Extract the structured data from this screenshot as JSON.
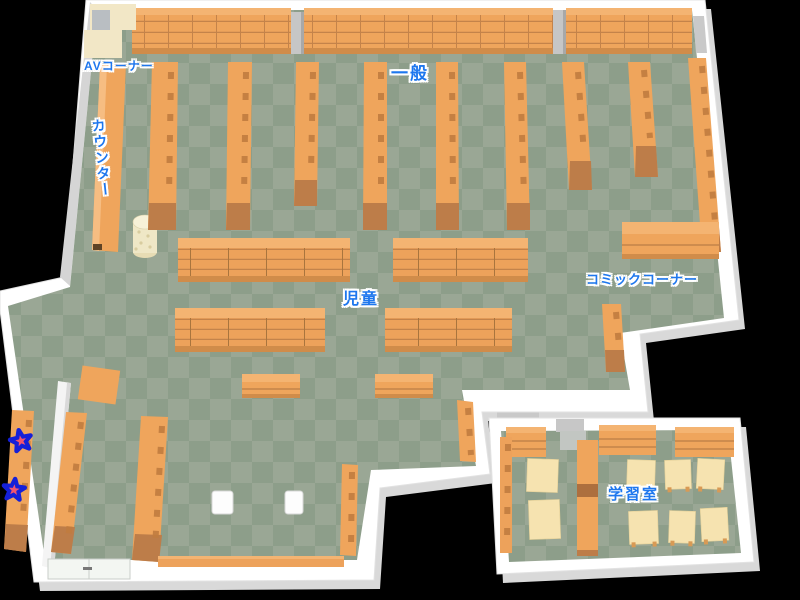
{
  "map": {
    "type": "library-floor-map",
    "labels": {
      "av_corner": "AVコーナー",
      "general": "一般",
      "counter": "カウンター",
      "children": "児童",
      "comic_corner": "コミックコーナー",
      "study_room": "学習室"
    },
    "markers": {
      "stars": 2
    },
    "colors": {
      "label_blue": "#1e77ee",
      "shelf_orange": "#efa55c",
      "shelf_top": "#f4b472",
      "shelf_edge": "#d08c4a",
      "shelf_cap": "#bd7d49",
      "floor_light": "#9aa795",
      "floor_dark": "#8d9e8a",
      "wall": "#ffffff",
      "table_cream": "#f6e3b0",
      "star_fill": "#fb8b96",
      "star_outline": "#1520d8",
      "background": "#000000"
    }
  }
}
